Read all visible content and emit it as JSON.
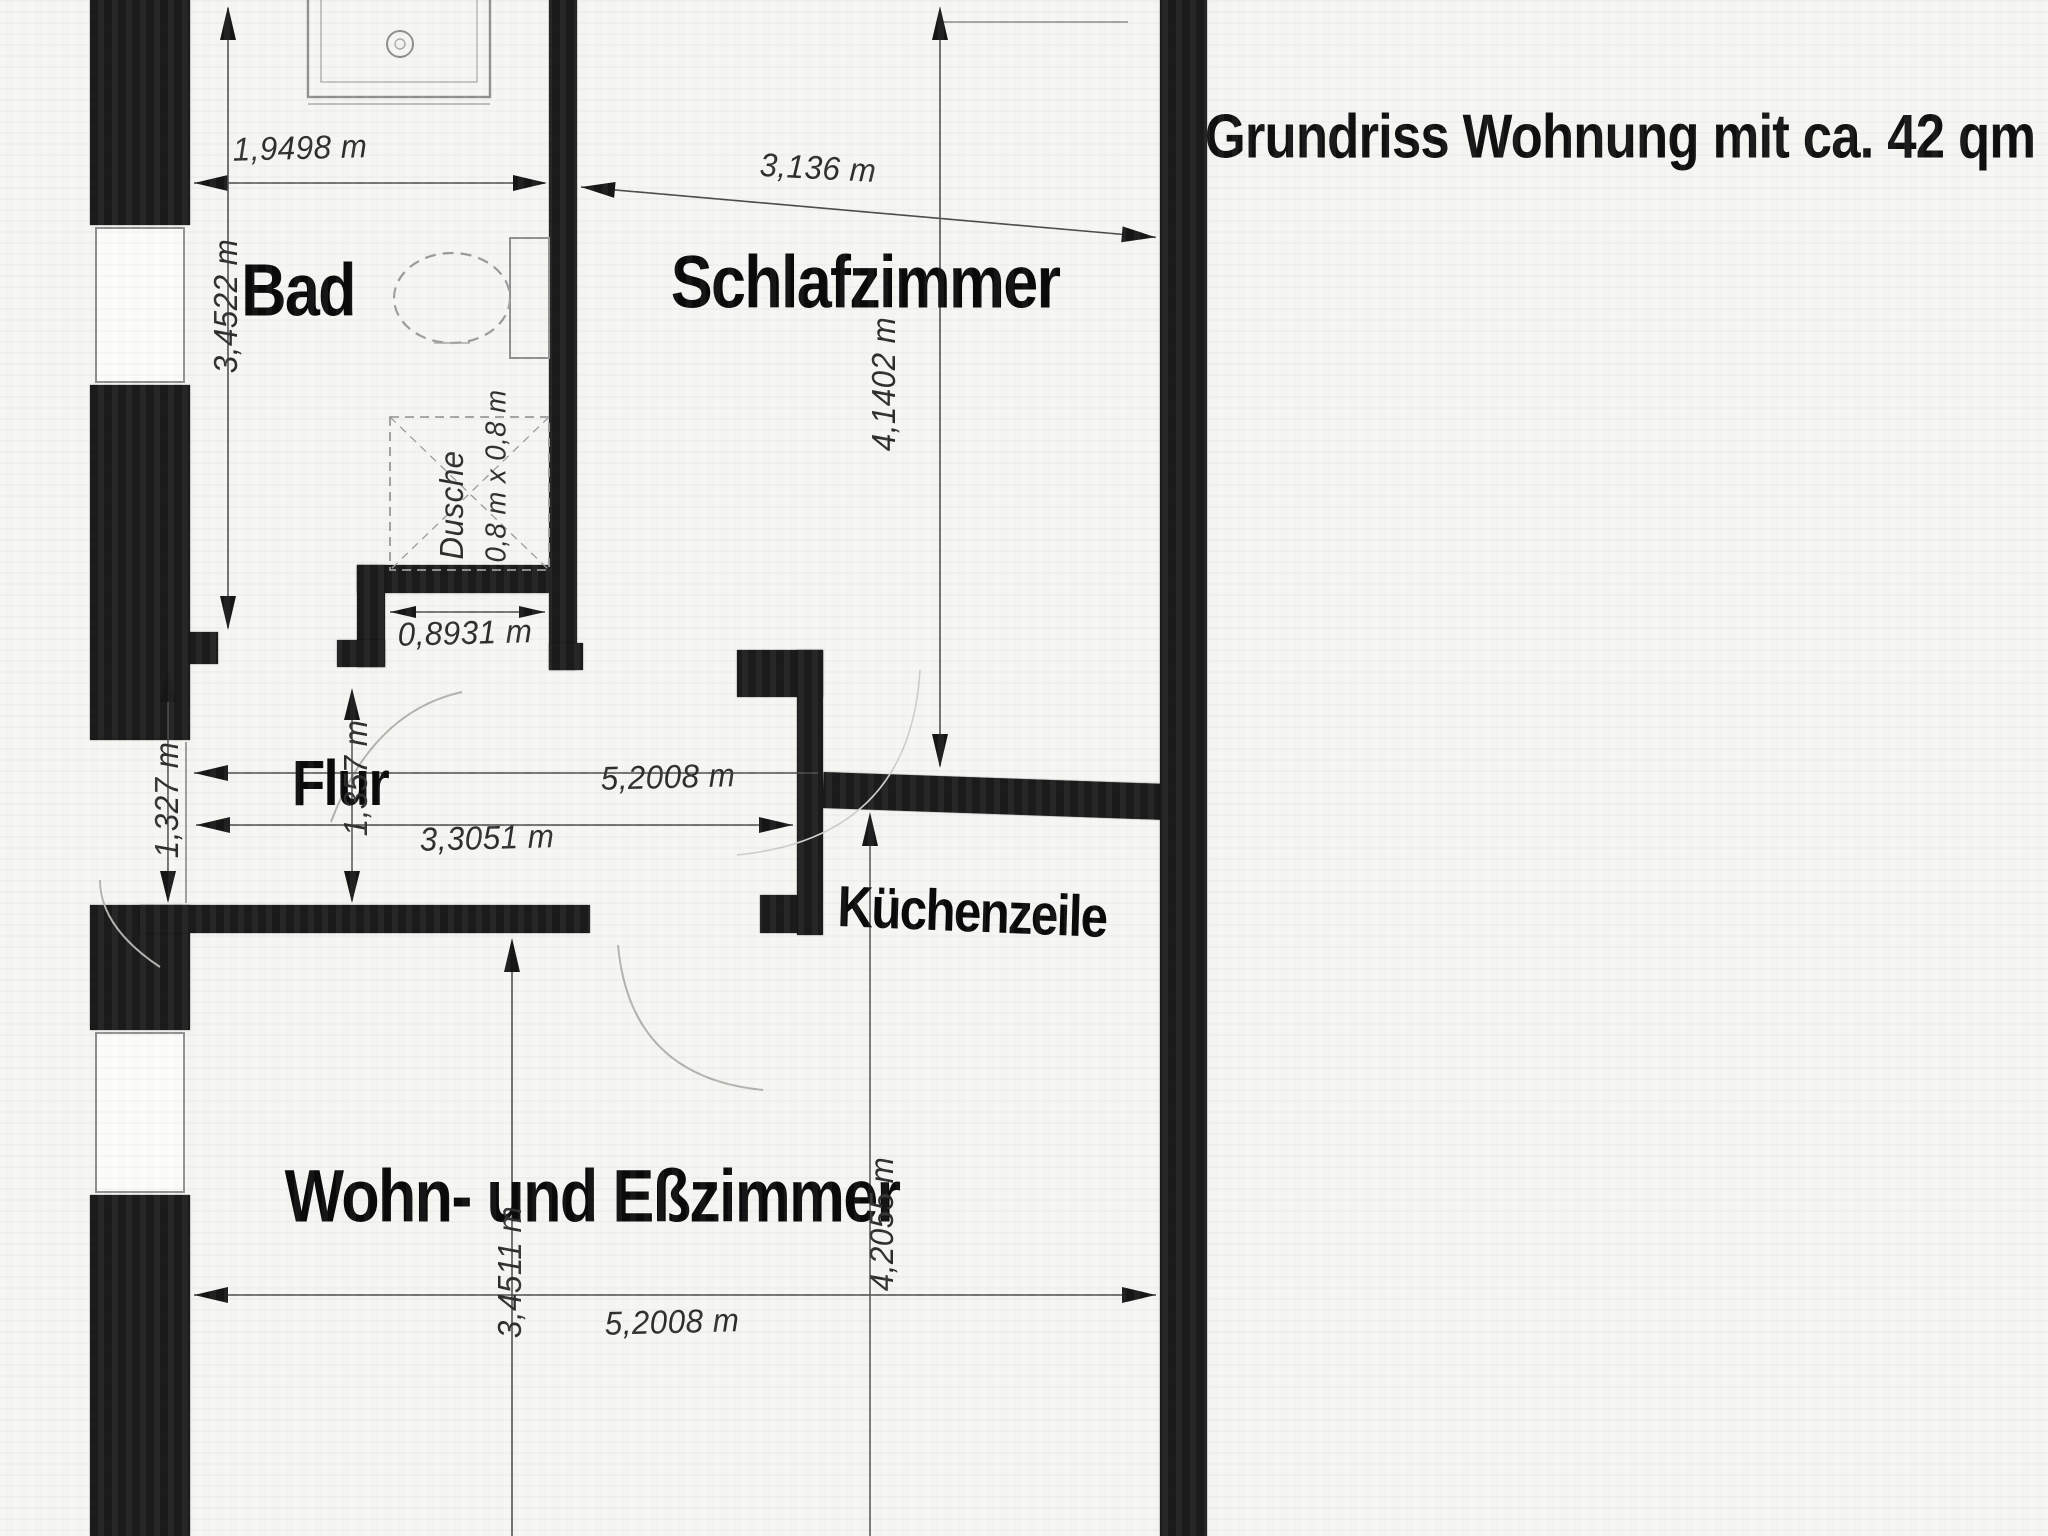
{
  "title": "Grundriss Wohnung mit ca. 42 qm",
  "rooms": {
    "bathroom": {
      "label": "Bad"
    },
    "bedroom": {
      "label": "Schlafzimmer"
    },
    "hallway": {
      "label": "Flur"
    },
    "kitchenette": {
      "label": "Küchenzeile"
    },
    "living_dining": {
      "label": "Wohn- und Eßzimmer"
    }
  },
  "shower": {
    "size_label": "0,8 m x 0,8 m",
    "label": "Dusche"
  },
  "dimensions": {
    "bath_width": "1,9498 m",
    "bath_height": "3,4522 m",
    "bedroom_width": "3,136 m",
    "bedroom_height": "4,1402 m",
    "passage_width": "0,8931 m",
    "hall_height_left": "1,327 m",
    "hall_height_mid": "1,357 m",
    "hall_width_full": "5,2008 m",
    "hall_width_partial": "3,3051 m",
    "living_width": "5,2008 m",
    "living_height_left": "3,4511 m",
    "living_height_right": "4,2055 m"
  },
  "colors": {
    "wall": "#1b1b1b",
    "dimension_line": "#4a4a4a",
    "fixture_line": "#8f8f8f",
    "paper": "#f6f6f3"
  }
}
